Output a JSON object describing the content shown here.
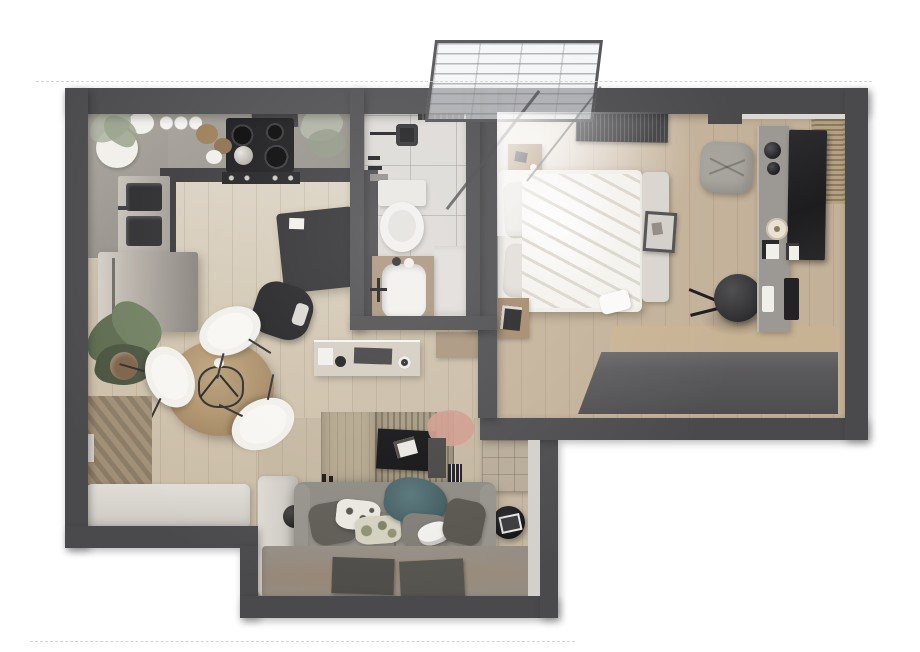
{
  "scene": {
    "title": "Top-down 3D render of a one-bedroom apartment floor plan",
    "rooms": [
      {
        "name": "kitchen",
        "furniture": [
          "l-shaped-concrete-counter",
          "black-cooktop-with-oven",
          "range-hood",
          "double-sink",
          "stainless-refrigerator",
          "plates-and-cups",
          "two-plants"
        ]
      },
      {
        "name": "dining-area",
        "furniture": [
          "round-wood-table",
          "three-white-shell-chairs",
          "large-potted-plant",
          "diagonal-wood-accent-wall",
          "l-shaped-bench"
        ]
      },
      {
        "name": "home-office-nook",
        "furniture": [
          "dark-desk",
          "black-office-chair",
          "console-table-with-accessories",
          "white-cabinet",
          "wood-cabinet"
        ]
      },
      {
        "name": "bathroom",
        "furniture": [
          "walk-in-shower",
          "toilet",
          "wood-vanity-with-basin",
          "vent-grille",
          "laundry-block"
        ]
      },
      {
        "name": "bedroom",
        "furniture": [
          "double-bed-white-bedding",
          "two-nightstands",
          "footboard-bench",
          "dark-wardrobe",
          "round-stool",
          "gray-pouf",
          "vanity-desk-with-dark-glass",
          "wood-slat-mat",
          "radiator",
          "glazed-balcony-above"
        ]
      },
      {
        "name": "living-room",
        "furniture": [
          "gray-sofa",
          "six-pillows",
          "teal-throw",
          "wall-mounted-tv",
          "slatted-tv-panel",
          "speakers",
          "pink-rug",
          "tufted-panel",
          "round-side-table",
          "area-rug",
          "two-dark-mats",
          "sphere-lamp"
        ]
      }
    ]
  },
  "colors": {
    "wall": "#4a4a4c",
    "floorKitchen": "#d6cebf",
    "floorHall": "#cabda7",
    "floorLiving": "#c4b6a0",
    "floorBedroom": "#c3b199",
    "tile": "#dcd9d5",
    "counterEdge": "#38373a",
    "appliance": "#151517",
    "sofa": "#8c8882",
    "sofaSeat": "#938f89",
    "pillowDark": "#5e5b55",
    "pillowWhite": "#eae7e0",
    "pillowCamo": "#d5d1bf",
    "pillowGray": "#7f7b75",
    "teal": "#4a676c",
    "bench": "#d9d5cf",
    "woodTable": "#b3976f",
    "woodNight": "#a98e6e",
    "woodCabinet": "#a8937b",
    "woodPanel": "#a3977f",
    "wardrobe": "#5a595b",
    "white": "#f1efea",
    "cream": "#e9e2d4",
    "plantDark": "#5d6b50",
    "plantPale": "#aeb4a3",
    "pink": "#cf9b8d",
    "dark": "#232225",
    "stool": "#3b3a3c",
    "tuft": "#b7aa98",
    "rug": "#948d84",
    "mat": "#4e4c48",
    "bedding": "#f0eee9",
    "gray": "#9c9893"
  }
}
